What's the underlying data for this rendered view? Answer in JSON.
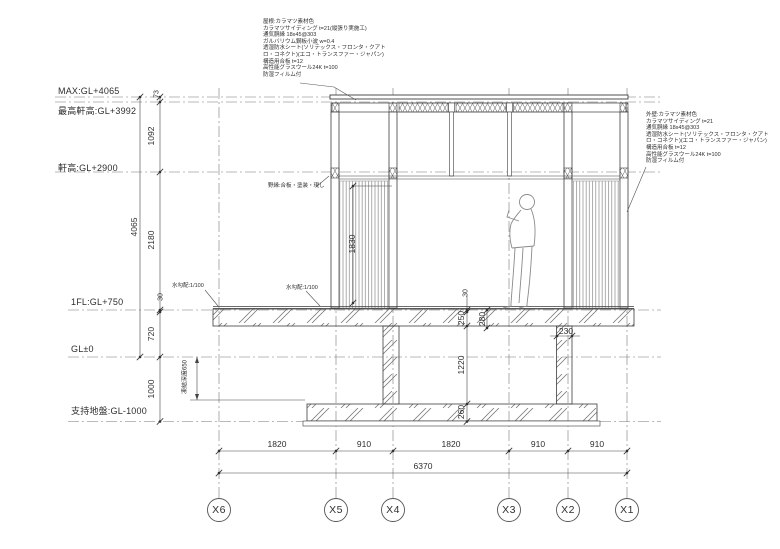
{
  "drawing": {
    "levels": [
      {
        "label": "MAX:GL+4065"
      },
      {
        "label": "最高軒高:GL+3992"
      },
      {
        "label": "軒高:GL+2900"
      },
      {
        "label": "1FL:GL+750"
      },
      {
        "label": "GL±0"
      },
      {
        "label": "支持地盤:GL-1000"
      }
    ],
    "vertical_dims": {
      "d73": "73",
      "d1092": "1092",
      "d2180": "2180",
      "d30_left": "30",
      "d720": "720",
      "d1000": "1000",
      "total_height": "4065",
      "louver_height": "1830",
      "frost_depth": "凍結深度650",
      "d30_center": "30",
      "d250": "250",
      "d280": "280",
      "d1220": "1220",
      "d260": "260"
    },
    "horizontal_dims": {
      "span1": "1820",
      "span2": "910",
      "span3": "1820",
      "span4": "910",
      "span5": "910",
      "total_width": "6370",
      "stem_width": "230"
    },
    "grid_labels": [
      "X6",
      "X5",
      "X4",
      "X3",
      "X2",
      "X1"
    ],
    "notes": {
      "roof_spec": [
        "屋根:カラマツ素材色",
        "カラマツサイディング t=21(縦張り実施工)",
        "通気胴縁 18x45@303",
        "ガルバリウム鋼板小波 w=0.4",
        "透湿防水シート(ソリテックス・フロンタ・クアト",
        "ロ・コネクト)(エコ・トランスファー・ジャパン)",
        "構造用合板 t=12",
        "高性能グラスウール24K t=100",
        "防湿フィルム付"
      ],
      "wall_spec": [
        "外壁:カラマツ素材色",
        "カラマツサイディング t=21",
        "通気胴縁 18x45@303",
        "透湿防水シート(ソリテックス・フロンタ・クアト",
        "ロ・コネクト)(エコ・トランスファー・ジャパン)",
        "構造用合板 t=12",
        "高性能グラスウール24K t=100",
        "防湿フィルム付"
      ],
      "ceiling": "野縁:合板・塗装・現し",
      "slope_left": "水勾配:1/100",
      "slope_right": "水勾配:1/100"
    },
    "line_color": "#3d3d3d"
  }
}
